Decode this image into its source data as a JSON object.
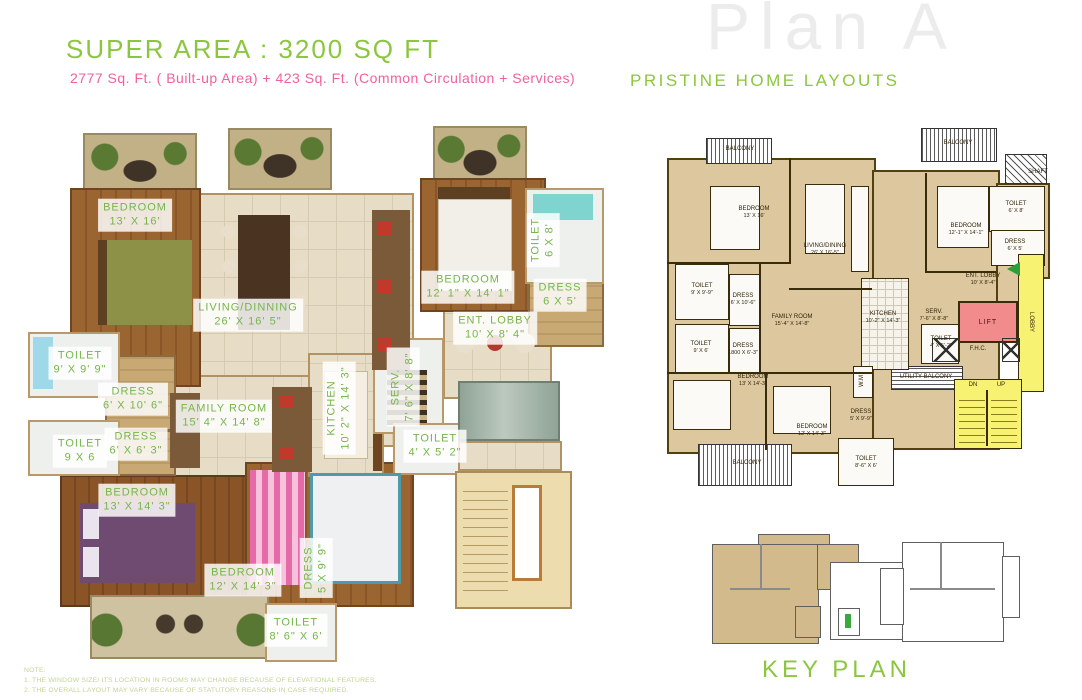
{
  "header": {
    "title": "SUPER AREA : 3200  SQ FT",
    "subtitle": "2777 Sq. Ft. ( Built-up Area) + 423 Sq. Ft. (Common Circulation + Services)",
    "watermark": "Plan A",
    "brand": "PRISTINE HOME LAYOUTS"
  },
  "colors": {
    "brand_green": "#8cc63e",
    "accent_pink": "#f0619f",
    "plan_tan": "#dcc79e",
    "lobby_yellow": "#f8f272",
    "lift_pink": "#f28b8b",
    "keyplan_highlight": "#d3ba8c",
    "watermark_gray": "#ececec"
  },
  "rendered_plan": {
    "labels": [
      {
        "name": "BEDROOM",
        "dims": "13' X 16'"
      },
      {
        "name": "LIVING/DINNING",
        "dims": "26' X 16' 5\""
      },
      {
        "name": "BEDROOM",
        "dims": "12' 1\" X 14' 1\""
      },
      {
        "name": "TOILET",
        "dims": "6 X 8'"
      },
      {
        "name": "DRESS",
        "dims": "6 X 5'"
      },
      {
        "name": "ENT. LOBBY",
        "dims": "10' X 8' 4\""
      },
      {
        "name": "TOILET",
        "dims": "9' X 9' 9\""
      },
      {
        "name": "DRESS",
        "dims": "6' X 10' 6\""
      },
      {
        "name": "DRESS",
        "dims": "6' X 6' 3\""
      },
      {
        "name": "TOILET",
        "dims": "9 X 6"
      },
      {
        "name": "FAMILY ROOM",
        "dims": "15' 4\" X 14' 8\""
      },
      {
        "name": "KITCHEN",
        "dims": "10' 2\" X 14' 3\""
      },
      {
        "name": "SERV.",
        "dims": "7' 6\" X 8' 8\""
      },
      {
        "name": "TOILET",
        "dims": "4' X 5' 2\""
      },
      {
        "name": "BEDROOM",
        "dims": "13' X 14' 3\""
      },
      {
        "name": "BEDROOM",
        "dims": "12' X 14' 3\""
      },
      {
        "name": "DRESS",
        "dims": "5 X 9' 9\""
      },
      {
        "name": "TOILET",
        "dims": "8' 6\" X 6'"
      }
    ]
  },
  "schematic_plan": {
    "labels": [
      {
        "name": "BALCONY",
        "dims": ""
      },
      {
        "name": "BEDROOM",
        "dims": "13' X 16'"
      },
      {
        "name": "LIVING/DINING",
        "dims": "26' X 16'-5\""
      },
      {
        "name": "BALCONY",
        "dims": ""
      },
      {
        "name": "SHAFT",
        "dims": ""
      },
      {
        "name": "BEDROOM",
        "dims": "12'-1\" X 14'-1\""
      },
      {
        "name": "TOILET",
        "dims": "6' X 8'"
      },
      {
        "name": "DRESS",
        "dims": "6' X 5'"
      },
      {
        "name": "ENT. LOBBY",
        "dims": "10' X 8'-4\""
      },
      {
        "name": "LIFT",
        "dims": ""
      },
      {
        "name": "LOBBY",
        "dims": ""
      },
      {
        "name": "SERV.",
        "dims": "7'-6\" X 8'-8\""
      },
      {
        "name": "TOILET",
        "dims": "4' X 5'-2\""
      },
      {
        "name": "F.H.C.",
        "dims": ""
      },
      {
        "name": "UTILITY  BALCONY",
        "dims": ""
      },
      {
        "name": "DN",
        "dims": ""
      },
      {
        "name": "UP",
        "dims": ""
      },
      {
        "name": "TOILET",
        "dims": "9' X 9'-9\""
      },
      {
        "name": "DRESS",
        "dims": "6' X 10'-6\""
      },
      {
        "name": "TOILET",
        "dims": "9' X 6'"
      },
      {
        "name": "DRESS",
        "dims": "1800 X 6'-3\""
      },
      {
        "name": "FAMILY ROOM",
        "dims": "15'-4\" X 14'-8\""
      },
      {
        "name": "KITCHEN",
        "dims": "10'-2\" X 14'-3\""
      },
      {
        "name": "BEDROOM",
        "dims": "13' X 14'-3\""
      },
      {
        "name": "BEDROOM",
        "dims": "12' X 14'-3\""
      },
      {
        "name": "DRESS",
        "dims": "5' X 9'-9\""
      },
      {
        "name": "TOILET",
        "dims": "8'-6\" X 6'"
      },
      {
        "name": "BALCONY",
        "dims": ""
      },
      {
        "name": "W.M",
        "dims": ""
      }
    ]
  },
  "key_plan": {
    "label": "KEY PLAN"
  },
  "notes": {
    "heading": "NOTE:",
    "line1": "1. THE WINDOW SIZE/ ITS LOCATION IN ROOMS MAY CHANGE BECAUSE OF ELEVATIONAL FEATURES.",
    "line2": "2. THE OVERALL LAYOUT MAY VARY BECAUSE OF STATUTORY REASONS IN CASE REQUIRED."
  }
}
